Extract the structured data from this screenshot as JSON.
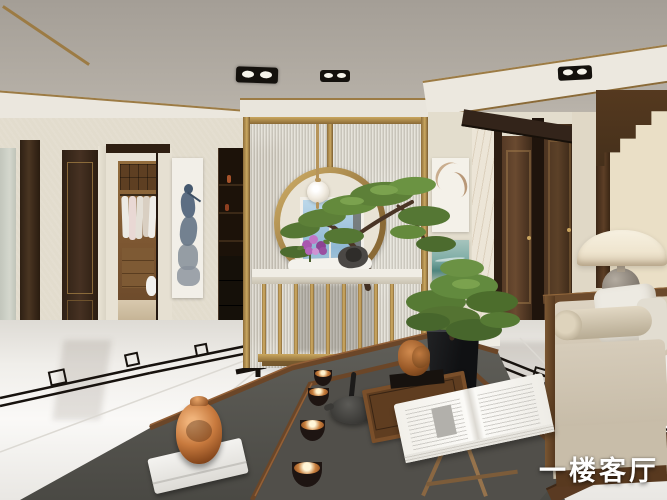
{
  "meta": {
    "description": "3D render of a new-Chinese-style living room",
    "canvas": {
      "width": 667,
      "height": 500
    }
  },
  "watermark": {
    "text": "一楼客厅",
    "color": "#ffffff"
  },
  "palette": {
    "ceiling": "#aaa49c",
    "wall_cream": "#e2dccd",
    "brass": "#b08d4c",
    "wood_dark": "#3c2a1c",
    "reeded_glass": "#d8d4ca",
    "sky_window": "#a9cce2",
    "pine_green": "#5d8038",
    "floor_white": "#f2f0ec",
    "inlay_black": "#17120e",
    "rug_grey": "#55544f",
    "copper": "#b5703a",
    "sofa_linen": "#d6ccba",
    "lamp_shade": "#f3ecdb",
    "teal_art": "#5d948c"
  },
  "scene": {
    "elements": [
      "ceiling-spotlights",
      "gold-trim",
      "moon-gate-partition",
      "reeded-glass",
      "pendant-globe-lamp",
      "window-sky",
      "pine-bonsai",
      "marble-console-table",
      "purple-flowers",
      "walk-in-closet",
      "ink-scroll-painting",
      "display-cabinet",
      "abstract-paintings",
      "wood-doors",
      "arch-panel",
      "dome-table-lamp",
      "linen-sofa",
      "bonsai-planter",
      "stone-tea-table",
      "copper-jar",
      "tealight-bowls",
      "teapot",
      "wood-tray",
      "bronze-sculpture",
      "open-book-stand",
      "marble-floor-inlay"
    ]
  }
}
